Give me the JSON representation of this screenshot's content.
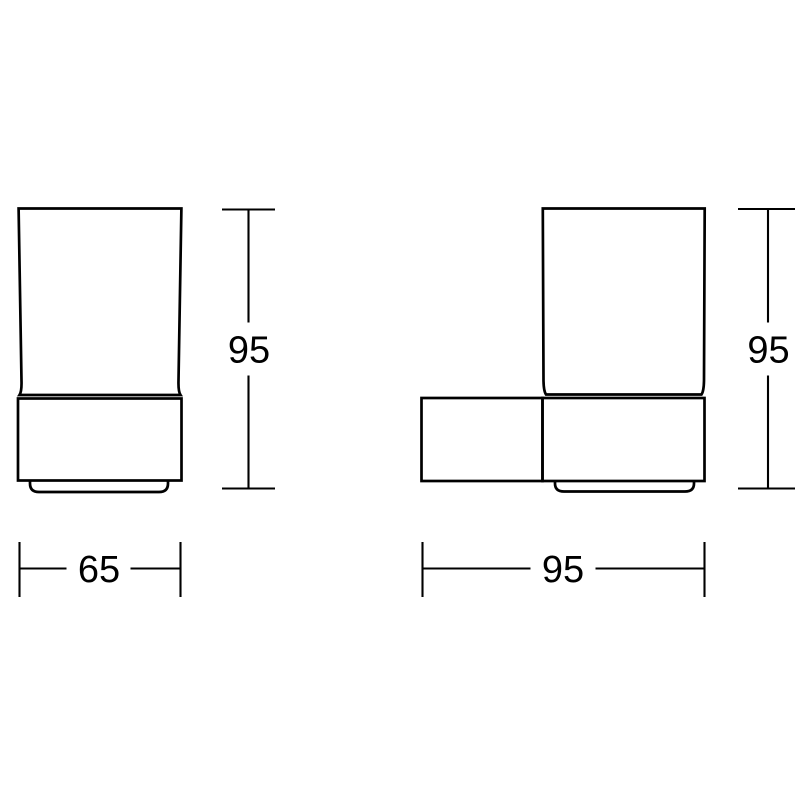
{
  "drawing": {
    "type": "technical-dimension-drawing",
    "background": "#ffffff",
    "line_color": "#000000",
    "views": {
      "front": {
        "description": "tumbler in wall holder, front elevation",
        "height_dim": "95",
        "width_dim": "65"
      },
      "side": {
        "description": "tumbler in wall holder with mounting plate, side elevation",
        "height_dim": "95",
        "depth_dim": "95"
      }
    }
  }
}
